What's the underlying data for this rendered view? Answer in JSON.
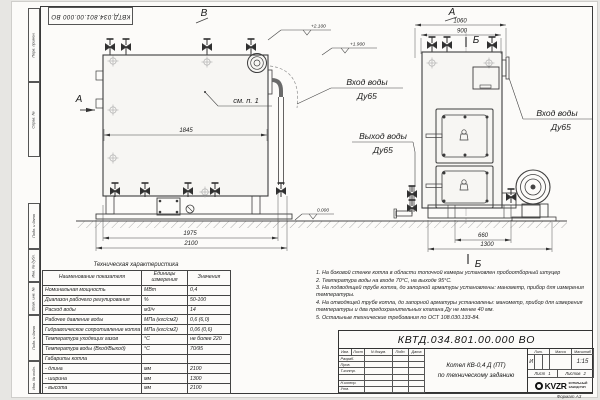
{
  "sheet": {
    "top_stamp": "КВТД.034.801.00.000 ВО",
    "format_note": "Формат А3",
    "side_labels": [
      "Перв. примен.",
      "Справ. №",
      "Подп. и дата",
      "Инв. № дубл.",
      "Взам. инв. №",
      "Подп. и дата",
      "Инв. № подл."
    ]
  },
  "drawing": {
    "view_b": "В",
    "view_a_top": "А",
    "view_a_arrow": "А",
    "section_b_top": "Б",
    "section_b_bottom": "Б",
    "callout": "см. п. 1",
    "labels": {
      "inlet_left_1": "Вход воды",
      "inlet_left_2": "Ду65",
      "outlet_1": "Выход воды",
      "outlet_2": "Ду65",
      "inlet_right_1": "Вход воды",
      "inlet_right_2": "Ду65"
    },
    "dims": {
      "d1845": "1845",
      "d1975": "1975",
      "d2100": "2100",
      "d1060": "1060",
      "d900": "900",
      "d660": "660",
      "d1300": "1300"
    },
    "elevations": {
      "top": "+2.100",
      "mid": "+1.900",
      "zero": "0.000"
    }
  },
  "spec_table": {
    "title": "Техническая характеристика",
    "col_name": "Наименование показателя",
    "col_unit": "Единицы измерения",
    "col_value": "Значения",
    "rows": [
      {
        "name": "Номинальная мощность",
        "unit": "МВт",
        "value": "0,4"
      },
      {
        "name": "Диапазон рабочего регулирования",
        "unit": "%",
        "value": "50-100"
      },
      {
        "name": "Расход воды",
        "unit": "м3/ч",
        "value": "14"
      },
      {
        "name": "Рабочее давление воды",
        "unit": "МПа (кгс/см2)",
        "value": "0,6 (6,0)"
      },
      {
        "name": "Гидравлическое сопротивление котла",
        "unit": "МПа (кгс/см2)",
        "value": "0,06 (0,6)"
      },
      {
        "name": "Температура уходящих газов",
        "unit": "°С",
        "value": "не более 220"
      },
      {
        "name": "Температура воды (Вход/Выход)",
        "unit": "°С",
        "value": "70/95"
      },
      {
        "name": "Габариты котла",
        "unit": "",
        "value": ""
      },
      {
        "name": "- длина",
        "unit": "мм",
        "value": "2100"
      },
      {
        "name": "- ширина",
        "unit": "мм",
        "value": "1300"
      },
      {
        "name": "- высота",
        "unit": "мм",
        "value": "2100"
      }
    ]
  },
  "notes": {
    "items": [
      "1.  На боковой стенке котла в области топочной камеры установлен пробоотборный штуцер",
      "2.  Температура воды на входе 70°С, на выходе 95°С.",
      "3.  На подводящей трубе котла, до запорной арматуры установлены: манометр, прибор для измерения температуры.",
      "4.  На отводящей трубе котла, до запорной арматуры установлены: манометр, прибор для измерения температуры и два предохранительных клапана Ду не менее 40 мм.",
      "5.  Остальные технические требования по ОСТ 108.030.133-84."
    ]
  },
  "title_block": {
    "designation": "КВТД.034.801.00.000  ВО",
    "name_line1": "Котел  КВ-0,4  Д  (ПТ)",
    "name_line2": "по техническому заданию",
    "col_izm": "Изм.",
    "col_list": "Лист",
    "col_doc": "N докум.",
    "col_sign": "Подп.",
    "col_date": "Дата",
    "row_razrab": "Разраб.",
    "row_prov": "Пров.",
    "row_tkontr": "Т.контр.",
    "row_nkontr": "Н.контр.",
    "row_utv": "Утв.",
    "lit_h": "Лит.",
    "mass_h": "Масса",
    "scale_h": "Масштаб",
    "lit_v": "И",
    "scale_v": "1:15",
    "sheet_h": "Лист",
    "sheet_v": "1",
    "sheets_h": "Листов",
    "sheets_v": "2",
    "logo_text": "KVZR",
    "company_1": "КОТЕЛЬНЫЙ",
    "company_2": "ЗАВОД РЭП"
  }
}
